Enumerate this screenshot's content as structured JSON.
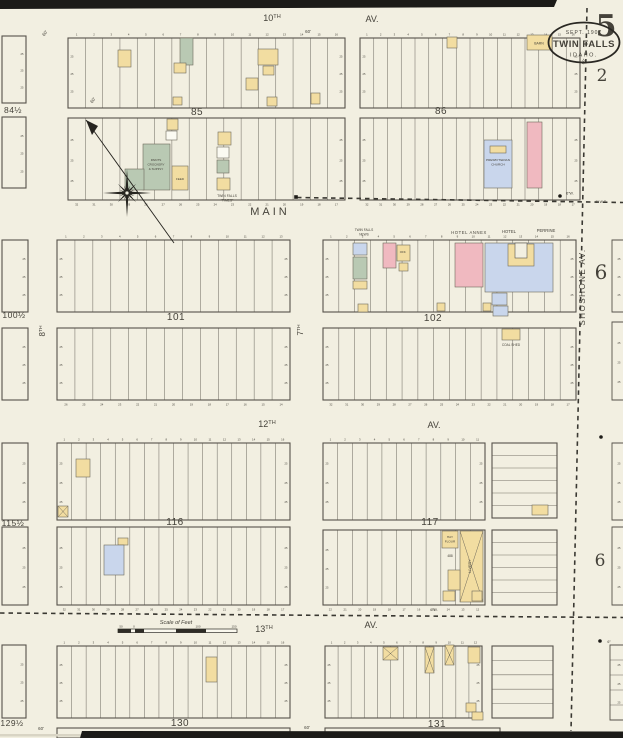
{
  "page": {
    "sheet_number": "5",
    "stamp": {
      "date": "SEPT. 1907",
      "city": "TWIN FALLS",
      "state": "IDAHO."
    },
    "adjacent_top": "2",
    "adjacent_right_upper": "6",
    "adjacent_right_lower": "6"
  },
  "legend_colors": {
    "frame": "#f2dda1",
    "brick": "#f0b9c0",
    "stone": "#c9d6ec",
    "special": "#b9c9b3",
    "white": "#fbfaf2",
    "paperfill": "#f2efe1",
    "paper": "#f2efe1",
    "line": "#56524a",
    "ink": "#3c3a33",
    "faint": "#8a8578"
  },
  "streets": [
    {
      "t": "10",
      "sup": "TH",
      "x": 272,
      "y": 21,
      "s": 9
    },
    {
      "t": "AV.",
      "x": 372,
      "y": 22,
      "s": 9
    },
    {
      "t": "MAIN",
      "x": 270,
      "y": 215,
      "s": 11,
      "sp": 3
    },
    {
      "t": "7",
      "sup": "TH",
      "x": 303,
      "y": 330,
      "s": 8,
      "rot": -90
    },
    {
      "t": "8",
      "sup": "TH",
      "x": 45,
      "y": 331,
      "s": 8,
      "rot": -90
    },
    {
      "t": "12",
      "sup": "TH",
      "x": 267,
      "y": 427,
      "s": 9
    },
    {
      "t": "AV.",
      "x": 434,
      "y": 428,
      "s": 9
    },
    {
      "t": "13",
      "sup": "TH",
      "x": 264,
      "y": 632,
      "s": 9
    },
    {
      "t": "AV.",
      "x": 371,
      "y": 628,
      "s": 9
    },
    {
      "t": "SHOSHONE  AV.",
      "x": 585,
      "y": 287,
      "s": 8,
      "rot": -90,
      "sp": 1.5
    }
  ],
  "blocks": [
    {
      "n": "85",
      "x": 68,
      "y": 38,
      "w": 277,
      "h": 70,
      "lots": 16,
      "numbers": "top",
      "label": [
        197,
        115
      ]
    },
    {
      "x": 68,
      "y": 118,
      "w": 277,
      "h": 82,
      "lots": 16,
      "numbers": "bottom"
    },
    {
      "n": "86",
      "x": 360,
      "y": 38,
      "w": 220,
      "h": 70,
      "lots": 16,
      "numbers": "top",
      "label": [
        441,
        114
      ]
    },
    {
      "x": 360,
      "y": 118,
      "w": 220,
      "h": 82,
      "lots": 16,
      "numbers": "bottom"
    },
    {
      "n": "84½",
      "x": 2,
      "y": 36,
      "w": 24,
      "h": 67,
      "label": [
        13,
        113
      ]
    },
    {
      "x": 2,
      "y": 117,
      "w": 24,
      "h": 71
    },
    {
      "n": "101",
      "x": 57,
      "y": 240,
      "w": 233,
      "h": 72,
      "lots": 13,
      "numbers": "top",
      "label": [
        176,
        320
      ]
    },
    {
      "x": 57,
      "y": 328,
      "w": 233,
      "h": 72,
      "lots": 13,
      "numbers": "bottom"
    },
    {
      "n": "102",
      "x": 323,
      "y": 240,
      "w": 253,
      "h": 72,
      "lots": 16,
      "numbers": "top",
      "label": [
        433,
        321
      ]
    },
    {
      "x": 323,
      "y": 328,
      "w": 253,
      "h": 72,
      "lots": 16,
      "numbers": "bottom"
    },
    {
      "n": "100½",
      "x": 2,
      "y": 240,
      "w": 26,
      "h": 72,
      "label": [
        14,
        318
      ]
    },
    {
      "x": 2,
      "y": 328,
      "w": 26,
      "h": 72
    },
    {
      "n": "116",
      "x": 57,
      "y": 443,
      "w": 233,
      "h": 77,
      "lots": 16,
      "numbers": "top",
      "label": [
        175,
        525
      ]
    },
    {
      "x": 57,
      "y": 527,
      "w": 233,
      "h": 78,
      "lots": 16,
      "numbers": "bottom"
    },
    {
      "n": "117",
      "x": 323,
      "y": 443,
      "w": 162,
      "h": 77,
      "lots": 11,
      "numbers": "top",
      "label": [
        430,
        525
      ]
    },
    {
      "x": 323,
      "y": 530,
      "w": 162,
      "h": 75,
      "lots": 11,
      "numbers": "bottom"
    },
    {
      "x": 492,
      "y": 443,
      "w": 65,
      "h": 75,
      "rows": 6
    },
    {
      "x": 492,
      "y": 530,
      "w": 65,
      "h": 75,
      "rows": 6
    },
    {
      "n": "115½",
      "x": 2,
      "y": 443,
      "w": 26,
      "h": 77,
      "label": [
        13,
        526
      ]
    },
    {
      "x": 2,
      "y": 527,
      "w": 26,
      "h": 78
    },
    {
      "n": "130",
      "x": 57,
      "y": 646,
      "w": 233,
      "h": 72,
      "lots": 16,
      "numbers": "top",
      "label": [
        180,
        726
      ]
    },
    {
      "n": "131",
      "x": 325,
      "y": 646,
      "w": 157,
      "h": 72,
      "lots": 12,
      "numbers": "top",
      "label": [
        437,
        727
      ]
    },
    {
      "x": 492,
      "y": 646,
      "w": 61,
      "h": 72,
      "rows": 5
    },
    {
      "n": "129½",
      "x": 2,
      "y": 645,
      "w": 24,
      "h": 73,
      "label": [
        12,
        726
      ]
    },
    {
      "x": 612,
      "y": 240,
      "w": 11,
      "h": 72,
      "stub": true
    },
    {
      "x": 612,
      "y": 322,
      "w": 11,
      "h": 78,
      "stub": true
    },
    {
      "x": 612,
      "y": 443,
      "w": 11,
      "h": 77,
      "stub": true
    },
    {
      "x": 612,
      "y": 527,
      "w": 11,
      "h": 78,
      "stub": true
    },
    {
      "x": 610,
      "y": 645,
      "w": 13,
      "h": 75,
      "stub": true,
      "rows": 5
    },
    {
      "x": 57,
      "y": 728,
      "w": 233,
      "h": 10
    },
    {
      "x": 325,
      "y": 728,
      "w": 175,
      "h": 10
    }
  ],
  "edge_dim_label": "25",
  "buildings": [
    {
      "blk": "85",
      "x": 180,
      "y": 38,
      "w": 13,
      "h": 27,
      "c": "special"
    },
    {
      "blk": "85",
      "x": 174,
      "y": 63,
      "w": 12,
      "h": 10,
      "c": "frame"
    },
    {
      "blk": "85",
      "x": 118,
      "y": 50,
      "w": 13,
      "h": 17,
      "c": "frame"
    },
    {
      "blk": "85",
      "x": 258,
      "y": 49,
      "w": 20,
      "h": 16,
      "c": "frame"
    },
    {
      "blk": "85",
      "x": 263,
      "y": 66,
      "w": 11,
      "h": 9,
      "c": "frame"
    },
    {
      "blk": "85",
      "x": 246,
      "y": 78,
      "w": 12,
      "h": 12,
      "c": "frame"
    },
    {
      "blk": "85",
      "x": 267,
      "y": 97,
      "w": 10,
      "h": 9,
      "c": "frame"
    },
    {
      "blk": "85",
      "x": 311,
      "y": 93,
      "w": 9,
      "h": 11,
      "c": "frame"
    },
    {
      "blk": "85",
      "x": 173,
      "y": 97,
      "w": 9,
      "h": 8,
      "c": "frame"
    },
    {
      "blk": "85",
      "x": 167,
      "y": 119,
      "w": 11,
      "h": 11,
      "c": "frame"
    },
    {
      "blk": "85",
      "x": 166,
      "y": 131,
      "w": 11,
      "h": 9,
      "c": "white"
    },
    {
      "blk": "85",
      "x": 143,
      "y": 144,
      "w": 27,
      "h": 46,
      "c": "special"
    },
    {
      "blk": "85",
      "x": 125,
      "y": 169,
      "w": 19,
      "h": 21,
      "c": "special"
    },
    {
      "blk": "85",
      "x": 172,
      "y": 166,
      "w": 16,
      "h": 24,
      "c": "frame"
    },
    {
      "blk": "85",
      "x": 218,
      "y": 132,
      "w": 13,
      "h": 13,
      "c": "frame"
    },
    {
      "blk": "85",
      "x": 217,
      "y": 147,
      "w": 12,
      "h": 11,
      "c": "white"
    },
    {
      "blk": "85",
      "x": 217,
      "y": 160,
      "w": 12,
      "h": 13,
      "c": "special"
    },
    {
      "blk": "85",
      "x": 217,
      "y": 178,
      "w": 13,
      "h": 12,
      "c": "frame"
    },
    {
      "blk": "86",
      "x": 447,
      "y": 37,
      "w": 10,
      "h": 11,
      "c": "frame"
    },
    {
      "blk": "86",
      "x": 527,
      "y": 35,
      "w": 25,
      "h": 15,
      "c": "frame"
    },
    {
      "blk": "86",
      "x": 484,
      "y": 140,
      "w": 28,
      "h": 48,
      "c": "stone"
    },
    {
      "blk": "86",
      "x": 490,
      "y": 146,
      "w": 16,
      "h": 7,
      "c": "frame"
    },
    {
      "blk": "86",
      "x": 527,
      "y": 122,
      "w": 15,
      "h": 66,
      "c": "brick"
    },
    {
      "blk": "102",
      "x": 353,
      "y": 243,
      "w": 14,
      "h": 12,
      "c": "stone"
    },
    {
      "blk": "102",
      "x": 353,
      "y": 257,
      "w": 14,
      "h": 22,
      "c": "special"
    },
    {
      "blk": "102",
      "x": 353,
      "y": 281,
      "w": 14,
      "h": 8,
      "c": "frame"
    },
    {
      "blk": "102",
      "x": 383,
      "y": 243,
      "w": 13,
      "h": 25,
      "c": "brick"
    },
    {
      "blk": "102",
      "x": 397,
      "y": 245,
      "w": 13,
      "h": 16,
      "c": "frame"
    },
    {
      "blk": "102",
      "x": 399,
      "y": 263,
      "w": 9,
      "h": 8,
      "c": "frame"
    },
    {
      "blk": "102",
      "x": 455,
      "y": 243,
      "w": 28,
      "h": 44,
      "c": "brick"
    },
    {
      "blk": "102",
      "x": 485,
      "y": 243,
      "w": 68,
      "h": 49,
      "c": "stone"
    },
    {
      "blk": "102",
      "x": 508,
      "y": 244,
      "w": 26,
      "h": 22,
      "c": "frame"
    },
    {
      "blk": "102",
      "x": 515,
      "y": 243,
      "w": 12,
      "h": 15,
      "c": "paperfill"
    },
    {
      "blk": "102",
      "x": 492,
      "y": 293,
      "w": 15,
      "h": 12,
      "c": "stone"
    },
    {
      "blk": "102",
      "x": 493,
      "y": 306,
      "w": 15,
      "h": 10,
      "c": "stone"
    },
    {
      "blk": "102",
      "x": 483,
      "y": 303,
      "w": 8,
      "h": 8,
      "c": "frame"
    },
    {
      "blk": "102",
      "x": 358,
      "y": 304,
      "w": 10,
      "h": 8,
      "c": "frame"
    },
    {
      "blk": "102",
      "x": 437,
      "y": 303,
      "w": 8,
      "h": 8,
      "c": "frame"
    },
    {
      "blk": "102",
      "x": 502,
      "y": 329,
      "w": 18,
      "h": 11,
      "c": "frame"
    },
    {
      "blk": "116",
      "x": 76,
      "y": 459,
      "w": 14,
      "h": 18,
      "c": "frame"
    },
    {
      "blk": "116",
      "x": 58,
      "y": 506,
      "w": 10,
      "h": 11,
      "c": "frame",
      "cross": true
    },
    {
      "blk": "116",
      "x": 118,
      "y": 538,
      "w": 10,
      "h": 7,
      "c": "frame"
    },
    {
      "blk": "116",
      "x": 104,
      "y": 545,
      "w": 20,
      "h": 30,
      "c": "stone"
    },
    {
      "blk": "117",
      "x": 532,
      "y": 505,
      "w": 16,
      "h": 10,
      "c": "frame"
    },
    {
      "blk": "117",
      "x": 442,
      "y": 531,
      "w": 16,
      "h": 17,
      "c": "frame"
    },
    {
      "blk": "117",
      "x": 460,
      "y": 531,
      "w": 23,
      "h": 71,
      "c": "frame",
      "cross": true
    },
    {
      "blk": "117",
      "x": 448,
      "y": 570,
      "w": 12,
      "h": 20,
      "c": "frame"
    },
    {
      "blk": "117",
      "x": 443,
      "y": 591,
      "w": 12,
      "h": 10,
      "c": "frame"
    },
    {
      "blk": "117",
      "x": 472,
      "y": 591,
      "w": 10,
      "h": 10,
      "c": "frame"
    },
    {
      "blk": "130",
      "x": 206,
      "y": 657,
      "w": 11,
      "h": 25,
      "c": "frame"
    },
    {
      "blk": "131",
      "x": 383,
      "y": 647,
      "w": 15,
      "h": 13,
      "c": "frame",
      "cross": true
    },
    {
      "blk": "131",
      "x": 425,
      "y": 647,
      "w": 9,
      "h": 26,
      "c": "frame",
      "cross": true
    },
    {
      "blk": "131",
      "x": 445,
      "y": 645,
      "w": 9,
      "h": 20,
      "c": "frame",
      "cross": true
    },
    {
      "blk": "131",
      "x": 468,
      "y": 647,
      "w": 12,
      "h": 16,
      "c": "frame"
    },
    {
      "blk": "131",
      "x": 466,
      "y": 703,
      "w": 10,
      "h": 9,
      "c": "frame"
    },
    {
      "blk": "131",
      "x": 472,
      "y": 712,
      "w": 11,
      "h": 8,
      "c": "frame"
    }
  ],
  "annotations": [
    {
      "t": "HOTEL ANNEX",
      "x": 469,
      "y": 234,
      "s": 4.2,
      "sp": 0.6
    },
    {
      "t": "HOTEL",
      "x": 509,
      "y": 233,
      "s": 4.2
    },
    {
      "t": "PERRINE",
      "x": 546,
      "y": 232,
      "s": 4.2
    },
    {
      "t": "TWIN FALLS",
      "x": 364,
      "y": 231,
      "s": 3.2
    },
    {
      "t": "NEWS",
      "x": 364,
      "y": 235.5,
      "s": 3.2
    },
    {
      "t": "TWIN FALLS",
      "x": 227,
      "y": 197,
      "s": 3.4
    },
    {
      "t": "“TIMES”",
      "x": 227,
      "y": 201.5,
      "s": 3.4
    },
    {
      "t": "PRESBYTERIAN",
      "x": 498,
      "y": 161,
      "s": 3.1
    },
    {
      "t": "CHURCH",
      "x": 498,
      "y": 165.5,
      "s": 3.1
    },
    {
      "t": "PAINTS",
      "x": 156,
      "y": 161,
      "s": 3
    },
    {
      "t": "CROCKERY",
      "x": 156,
      "y": 165.5,
      "s": 3
    },
    {
      "t": "& SUPPLY",
      "x": 156,
      "y": 170,
      "s": 3
    },
    {
      "t": "FEED",
      "x": 180,
      "y": 180,
      "s": 3
    },
    {
      "t": "BARN",
      "x": 539,
      "y": 44.5,
      "s": 3.4
    },
    {
      "t": "OFF.",
      "x": 403,
      "y": 253,
      "s": 3
    },
    {
      "t": "COAL SHED",
      "x": 511,
      "y": 346,
      "s": 3.2
    },
    {
      "t": "HAY",
      "x": 450,
      "y": 538,
      "s": 3.1
    },
    {
      "t": "FLOUR",
      "x": 450,
      "y": 542.5,
      "s": 3.1
    },
    {
      "t": "488",
      "x": 450,
      "y": 557,
      "s": 3.2
    },
    {
      "t": "LIVERY",
      "x": 471,
      "y": 566,
      "s": 3.8,
      "rot": -90
    },
    {
      "t": "Scale of Feet",
      "x": 176,
      "y": 624,
      "s": 5.5,
      "i": true
    },
    {
      "t": "50",
      "x": 121,
      "y": 627.5,
      "s": 3
    },
    {
      "t": "0",
      "x": 134,
      "y": 627.5,
      "s": 3
    },
    {
      "t": "100",
      "x": 198,
      "y": 627.5,
      "s": 3
    },
    {
      "t": "150",
      "x": 234,
      "y": 627.5,
      "s": 3
    },
    {
      "t": "6″W.",
      "x": 570,
      "y": 194.5,
      "s": 3.6
    },
    {
      "t": "6″ W.T.",
      "x": 601,
      "y": 203,
      "s": 3.6
    },
    {
      "t": "6″W.",
      "x": 434,
      "y": 611,
      "s": 3.6
    },
    {
      "t": "6″",
      "x": 609,
      "y": 643,
      "s": 3.6
    },
    {
      "t": "60'",
      "x": 308,
      "y": 33,
      "s": 4.4
    },
    {
      "t": "60'",
      "x": 46,
      "y": 34,
      "s": 4.4,
      "rot": -55
    },
    {
      "t": "60'",
      "x": 94,
      "y": 101,
      "s": 4.4,
      "rot": -55
    },
    {
      "t": "60'",
      "x": 585,
      "y": 62,
      "s": 4.2,
      "rot": -70
    },
    {
      "t": "60'",
      "x": 41,
      "y": 730,
      "s": 4.4
    },
    {
      "t": "60'",
      "x": 307,
      "y": 729,
      "s": 4.4
    }
  ],
  "dashed_lines": [
    {
      "x1": 587,
      "y1": 8,
      "x2": 571,
      "y2": 731
    },
    {
      "x1": 297,
      "y1": 197.5,
      "x2": 623,
      "y2": 202.5
    },
    {
      "x1": 0,
      "y1": 613,
      "x2": 623,
      "y2": 617.5
    }
  ],
  "dots": [
    {
      "x": 296,
      "y": 197,
      "sq": true
    },
    {
      "x": 560,
      "y": 196
    },
    {
      "x": 601,
      "y": 437
    },
    {
      "x": 600,
      "y": 641
    }
  ],
  "compass": {
    "cx": 127,
    "cy": 193,
    "arrow": {
      "x1": 86,
      "y1": 120,
      "x2": 174,
      "y2": 243
    }
  },
  "scalebar": {
    "x": 118,
    "y": 629,
    "w": 119,
    "h": 3.6,
    "darks": [
      [
        0,
        13
      ],
      [
        17,
        9
      ],
      [
        58,
        30
      ]
    ]
  }
}
